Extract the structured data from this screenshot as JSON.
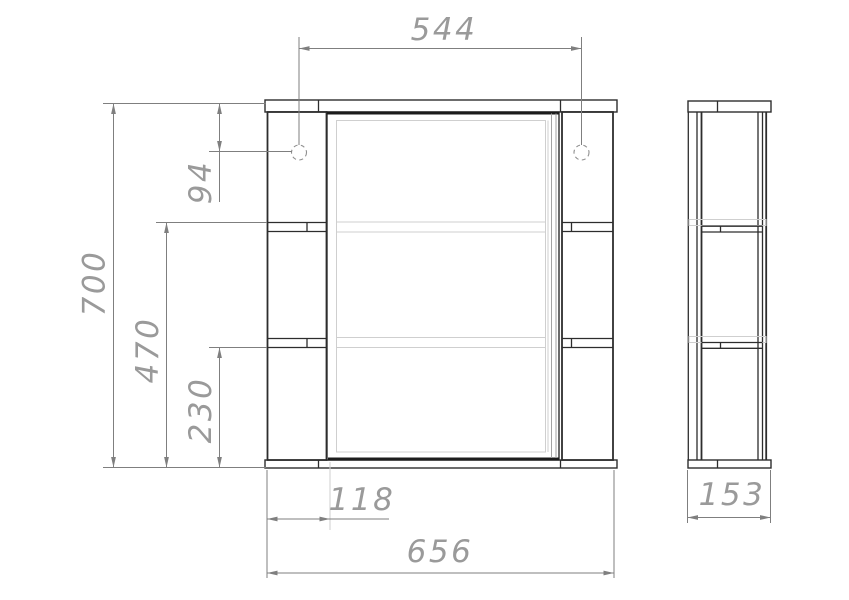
{
  "dimensions": {
    "hinge_spacing": "544",
    "overall_height": "700",
    "hinge_top_offset": "94",
    "upper_shelf_from_bottom": "470",
    "lower_shelf_from_bottom": "230",
    "side_section_width": "118",
    "overall_width": "656",
    "depth": "153"
  },
  "colors": {
    "outline_dark": "#2d2d2d",
    "dimension_gray": "#7f7f7f",
    "hidden_light": "#cfcfcf",
    "label_text": "#9a9a9a",
    "background": "#ffffff"
  }
}
